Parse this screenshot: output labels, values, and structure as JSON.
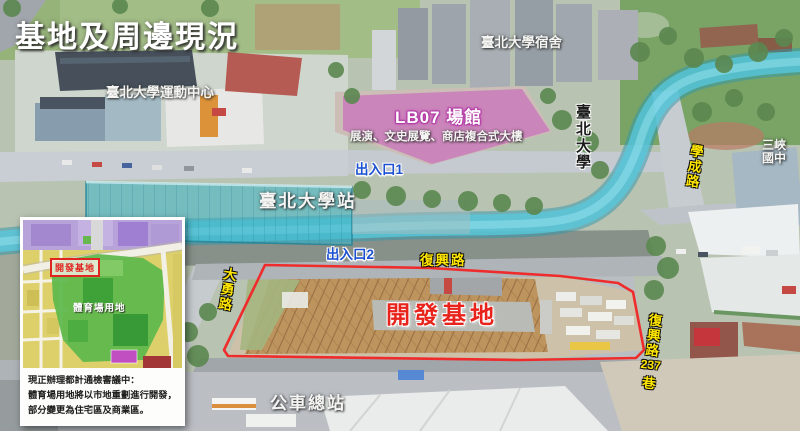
{
  "title": "基地及周邊現況",
  "colors": {
    "mrt_line": "#4cc4da",
    "station_fill": "#2fb0c6",
    "lb07_area": "#c446b8",
    "site_outline": "#ee1c1c",
    "road_label_yellow": "#ffe600",
    "exit_label_blue": "#1b50d0",
    "site_label_red": "#e8231c"
  },
  "map_labels": {
    "sports_center": "臺北大學運動中心",
    "dormitory": "臺北大學宿舍",
    "lb07_title": "LB07 場館",
    "lb07_subtitle": "展演、文史展覽、商店複合式大樓",
    "university": "臺北大學",
    "xuecheng_road": "學成路",
    "sanxia_line1": "三峽",
    "sanxia_line2": "國中",
    "station": "臺北大學站",
    "exit1": "出入口1",
    "exit2": "出入口2",
    "fuxing_road": "復興路",
    "dayong_road": "大勇路",
    "development_site": "開發基地",
    "fuxing_lane_road": "復興路",
    "fuxing_lane_number": "237",
    "fuxing_lane_suffix": "巷",
    "bus_terminal": "公車總站"
  },
  "inset": {
    "site_label": "開發基地",
    "stadium_label": "體育場用地",
    "caption_lines": [
      "現正辦理都計通檢審議中：",
      "體育場用地將以市地重劃進行開發，",
      "部分變更為住宅區及商業區。"
    ]
  }
}
